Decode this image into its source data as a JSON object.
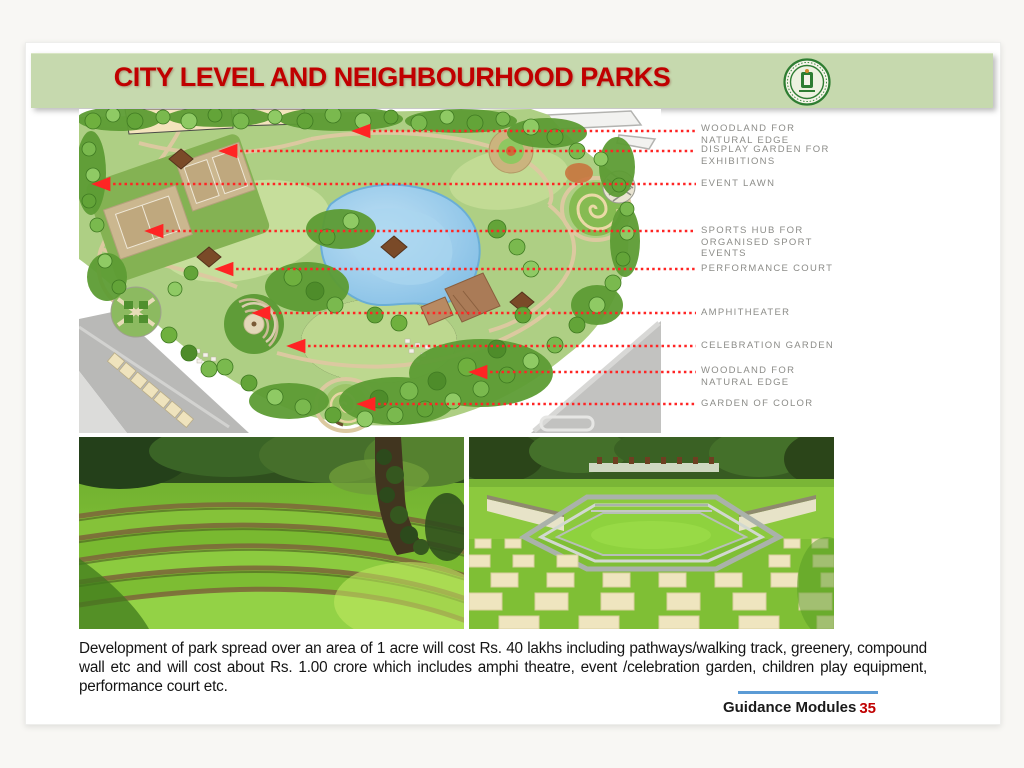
{
  "header": {
    "title": "CITY LEVEL AND NEIGHBOURHOOD PARKS",
    "logo_name": "government-seal"
  },
  "plan_labels": [
    {
      "text": "WOODLAND FOR\nNATURAL EDGE"
    },
    {
      "text": "DISPLAY GARDEN FOR\nEXHIBITIONS"
    },
    {
      "text": "EVENT LAWN"
    },
    {
      "text": "SPORTS HUB FOR\nORGANISED SPORT\nEVENTS"
    },
    {
      "text": "PERFORMANCE COURT"
    },
    {
      "text": "AMPHITHEATER"
    },
    {
      "text": "CELEBRATION GARDEN"
    },
    {
      "text": "WOODLAND FOR\nNATURAL EDGE"
    },
    {
      "text": "GARDEN OF COLOR"
    }
  ],
  "body_text": "Development of park spread over an area of 1 acre will cost Rs. 40 lakhs including pathways/walking track, greenery, compound wall etc and will cost about Rs. 1.00 crore which includes amphi theatre, event /celebration garden, children play equipment, performance court etc.",
  "footer": {
    "label": "Guidance Modules",
    "page_number": "35"
  },
  "colors": {
    "banner_green": "#c6d9ae",
    "title_red": "#c00000",
    "leader_red": "#ff2424",
    "label_gray": "#8c8c88",
    "accent_blue": "#5b9bd5"
  }
}
